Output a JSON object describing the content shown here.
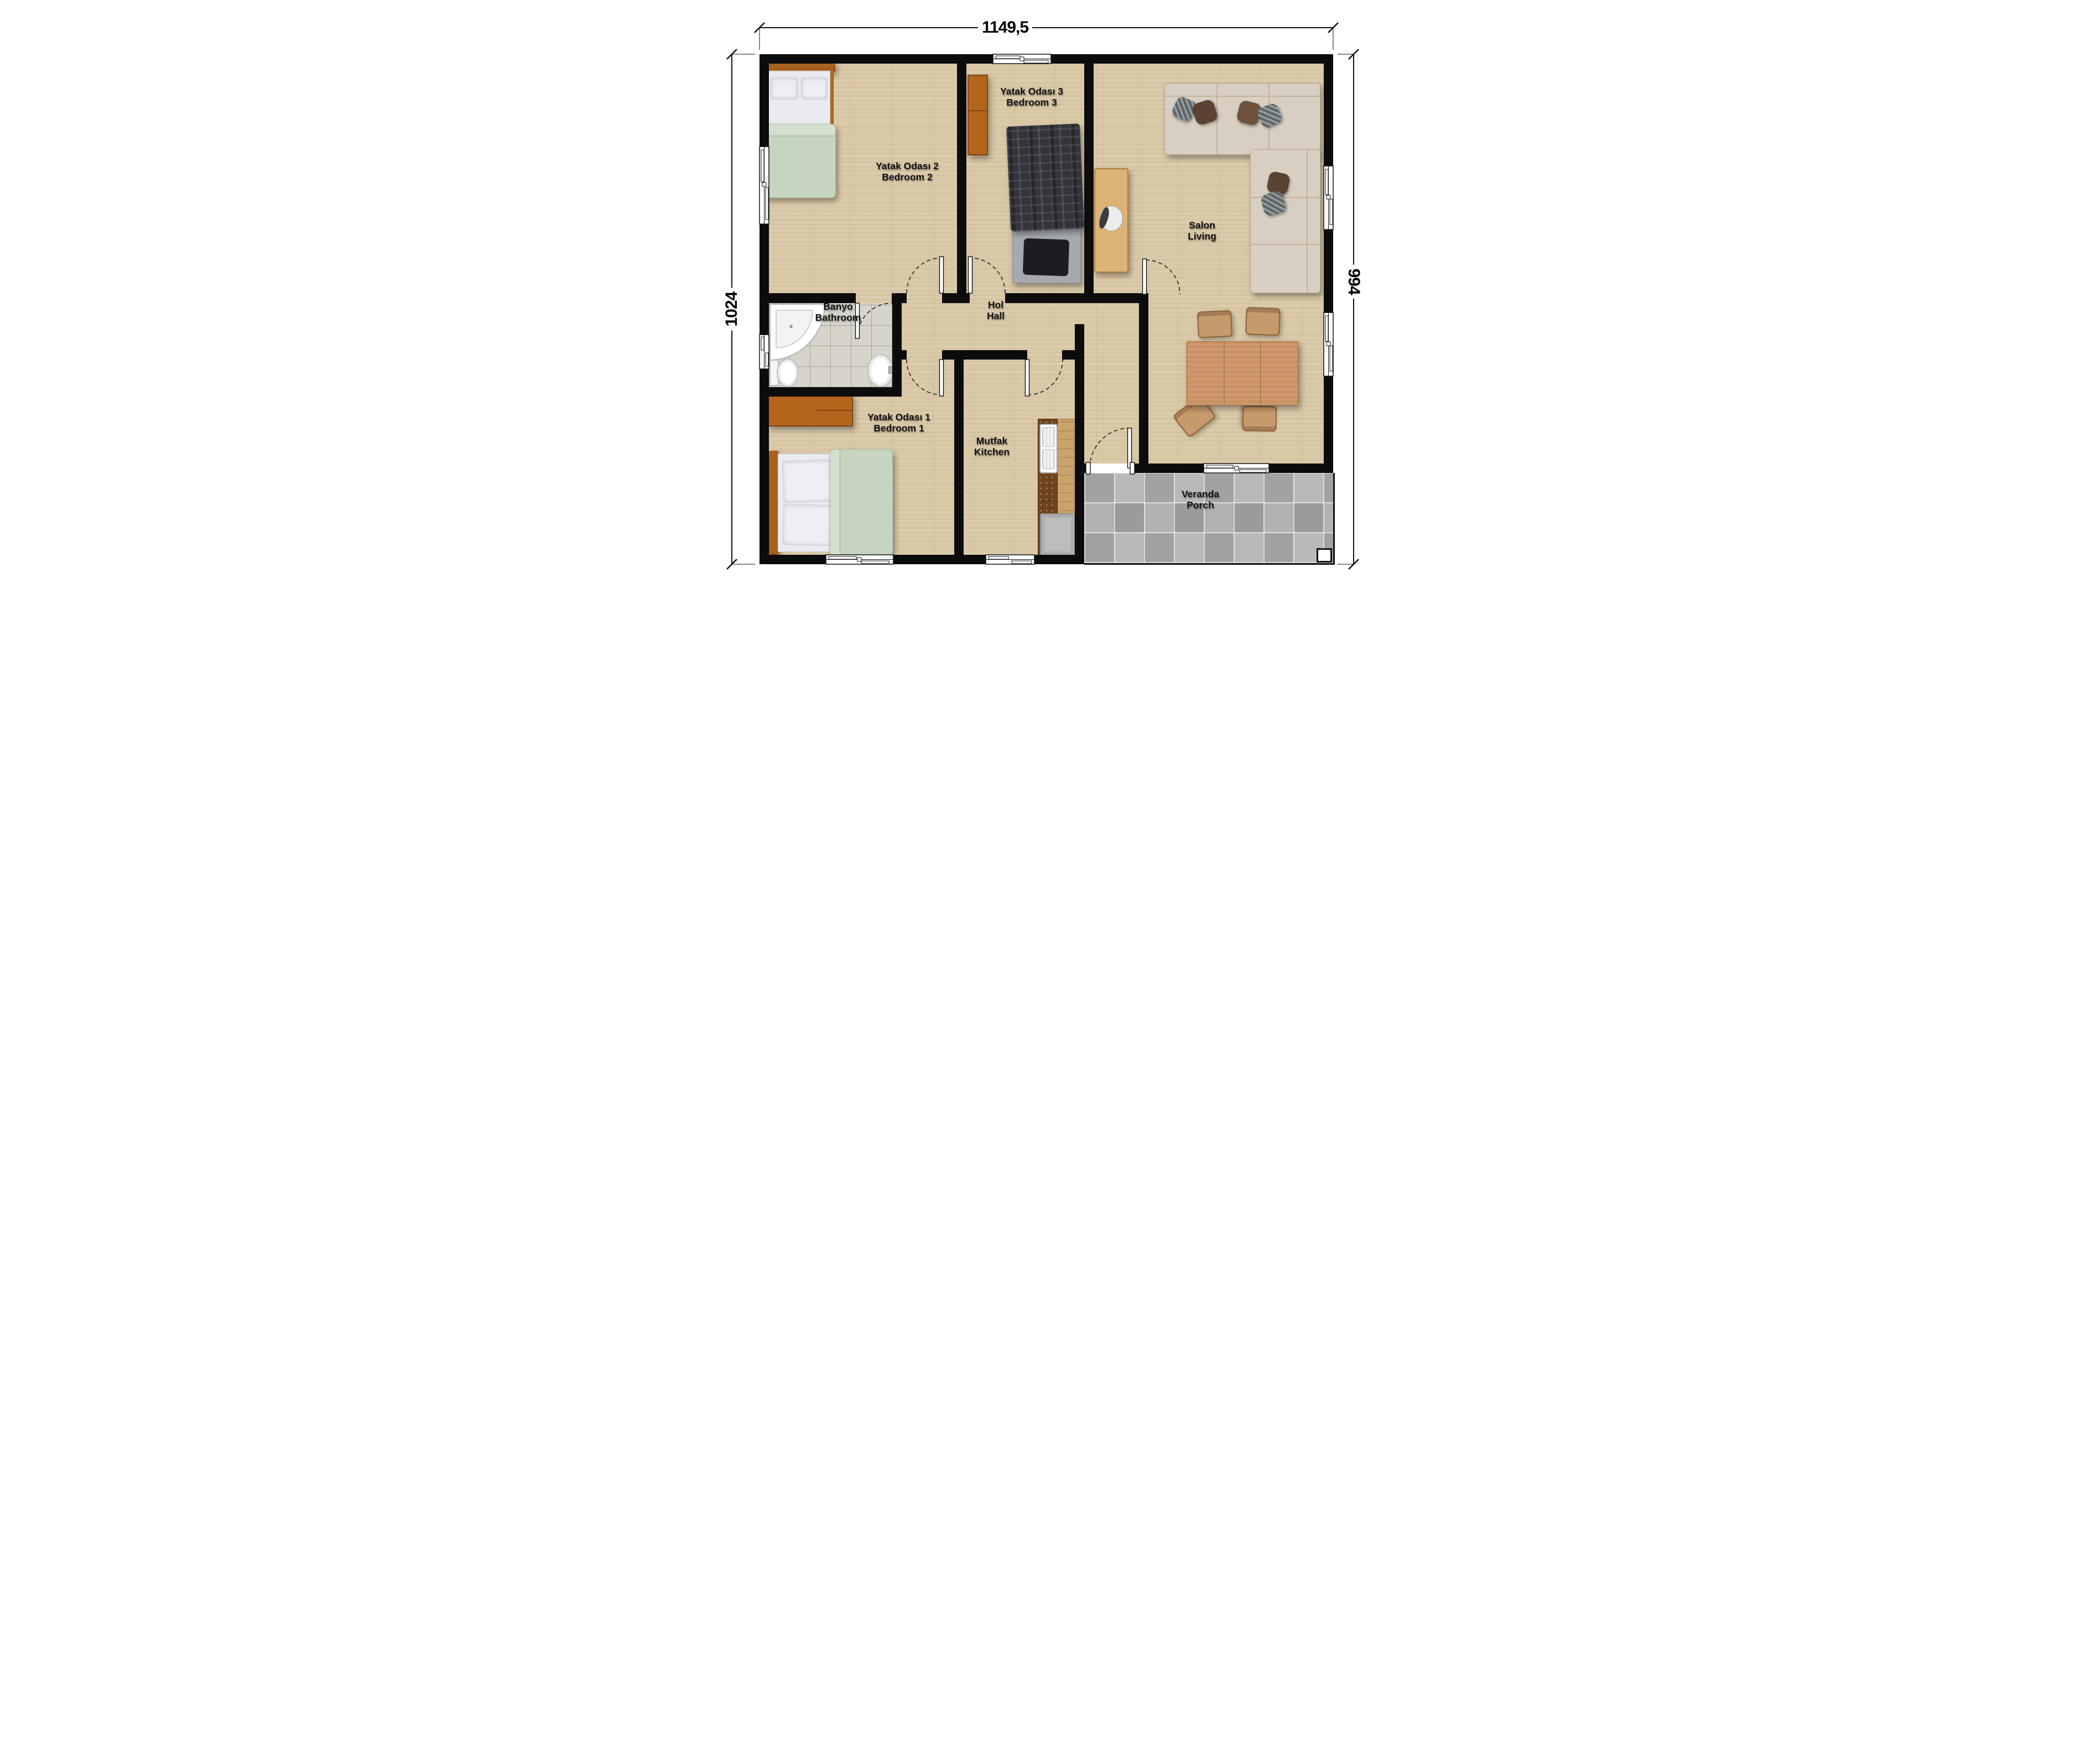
{
  "plan": {
    "title": "Prefabricated house floor plan",
    "dimensions": {
      "top": "1149,5",
      "left": "1024",
      "right": "994"
    },
    "rooms": [
      {
        "id": "bedroom2",
        "tr": "Yatak Odası 2",
        "en": "Bedroom 2"
      },
      {
        "id": "bedroom3",
        "tr": "Yatak Odası 3",
        "en": "Bedroom 3"
      },
      {
        "id": "living",
        "tr": "Salon",
        "en": "Living"
      },
      {
        "id": "hall",
        "tr": "Hol",
        "en": "Hall"
      },
      {
        "id": "bathroom",
        "tr": "Banyo",
        "en": "Bathroom"
      },
      {
        "id": "bedroom1",
        "tr": "Yatak Odası 1",
        "en": "Bedroom 1"
      },
      {
        "id": "kitchen",
        "tr": "Mutfak",
        "en": "Kitchen"
      },
      {
        "id": "porch",
        "tr": "Veranda",
        "en": "Porch"
      }
    ],
    "colors": {
      "wall": "#0c0c0c",
      "wood_floor": "#d9c9a7",
      "bath_tile": "#d7d4ca",
      "porch_tile": "#ababab",
      "duvet_green": "#c6d5bf",
      "furniture_brown": "#b5641e",
      "sofa_beige": "#d8cec1"
    }
  }
}
